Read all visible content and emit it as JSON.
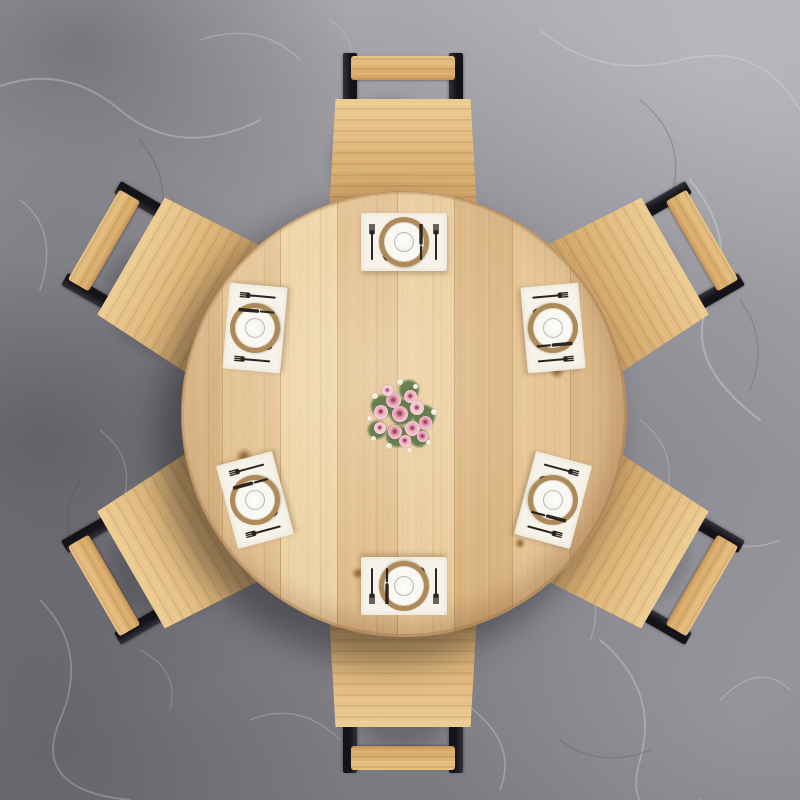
{
  "meta": {
    "description": "Top-down view of a round light oak dining table on a gray marble floor, with six wooden chairs with black metal backrest brackets, six place settings with white placemats, tan-rimmed plates and dark cutlery, and a centerpiece bouquet of pink roses with white buds and green leaves"
  },
  "palette": {
    "floor": "#95949a",
    "floorLight": "#b2b1b6",
    "floorDark": "#74737a",
    "vein": "#e4e3e6",
    "tableWood": "#ddbb8a",
    "tableWoodLight": "#ecd2a4",
    "tableWoodDark": "#c9a26e",
    "chairWood": "#d2a160",
    "chairWoodLight": "#e8c386",
    "metal": "#141318",
    "mat": "#f6f3eb",
    "plateRim": "#ae8a58",
    "plateWhite": "#f9f8f3",
    "plateLine": "#bcb9ae",
    "cutlery": "#2b261f",
    "rose1": "#e08ba4",
    "rose2": "#eda9bc",
    "rose3": "#f3c3cf",
    "bud": "#f3ecd9",
    "leaf": "#5e7b49"
  },
  "table": {
    "cx": 403,
    "cy": 413,
    "radius": 222
  },
  "chairs": {
    "radius": 270,
    "angles": [
      0,
      60,
      120,
      180,
      240,
      300
    ]
  },
  "place_settings": {
    "radius": 172,
    "items": [
      {
        "angle": 0,
        "rotation": 0
      },
      {
        "angle": 60,
        "rotation": 85
      },
      {
        "angle": 120,
        "rotation": 105
      },
      {
        "angle": 180,
        "rotation": 180
      },
      {
        "angle": 240,
        "rotation": 255
      },
      {
        "angle": 300,
        "rotation": 275
      }
    ],
    "cutlery_left": [
      "fork",
      "spoon"
    ],
    "cutlery_right": [
      "knife",
      "fork"
    ]
  },
  "knots": [
    {
      "x": 438,
      "y": 247,
      "r": 8
    },
    {
      "x": 243,
      "y": 456,
      "r": 9
    },
    {
      "x": 556,
      "y": 371,
      "r": 8
    },
    {
      "x": 357,
      "y": 573,
      "r": 7
    },
    {
      "x": 519,
      "y": 543,
      "r": 6
    }
  ],
  "centerpiece": {
    "cx": 401,
    "cy": 414,
    "leaves": [
      {
        "dx": -20,
        "dy": -9,
        "d": 22
      },
      {
        "dx": 7,
        "dy": -25,
        "d": 20
      },
      {
        "dx": 22,
        "dy": 1,
        "d": 22
      },
      {
        "dx": -5,
        "dy": 21,
        "d": 22
      },
      {
        "dx": -25,
        "dy": 15,
        "d": 18
      },
      {
        "dx": 17,
        "dy": 23,
        "d": 18
      },
      {
        "dx": 0,
        "dy": -3,
        "d": 26
      }
    ],
    "roses": [
      {
        "dx": -9,
        "dy": -15,
        "d": 15,
        "c": "rose1"
      },
      {
        "dx": 8,
        "dy": -19,
        "d": 13,
        "c": "rose2"
      },
      {
        "dx": -21,
        "dy": -3,
        "d": 14,
        "c": "rose2"
      },
      {
        "dx": -2,
        "dy": -1,
        "d": 16,
        "c": "rose1"
      },
      {
        "dx": 15,
        "dy": -7,
        "d": 14,
        "c": "rose3"
      },
      {
        "dx": 23,
        "dy": 7,
        "d": 13,
        "c": "rose1"
      },
      {
        "dx": 10,
        "dy": 13,
        "d": 15,
        "c": "rose2"
      },
      {
        "dx": -7,
        "dy": 17,
        "d": 14,
        "c": "rose1"
      },
      {
        "dx": -22,
        "dy": 13,
        "d": 12,
        "c": "rose3"
      },
      {
        "dx": 3,
        "dy": 26,
        "d": 12,
        "c": "rose2"
      },
      {
        "dx": 20,
        "dy": 21,
        "d": 11,
        "c": "rose1"
      },
      {
        "dx": -15,
        "dy": -25,
        "d": 11,
        "c": "rose3"
      }
    ],
    "buds": [
      {
        "dx": -2,
        "dy": -33,
        "d": 6
      },
      {
        "dx": 13,
        "dy": -29,
        "d": 5
      },
      {
        "dx": -27,
        "dy": -19,
        "d": 6
      },
      {
        "dx": -33,
        "dy": 3,
        "d": 5
      },
      {
        "dx": -29,
        "dy": 23,
        "d": 5
      },
      {
        "dx": -13,
        "dy": 31,
        "d": 6
      },
      {
        "dx": 7,
        "dy": 35,
        "d": 5
      },
      {
        "dx": 26,
        "dy": 27,
        "d": 5
      },
      {
        "dx": 32,
        "dy": -3,
        "d": 6
      }
    ]
  }
}
